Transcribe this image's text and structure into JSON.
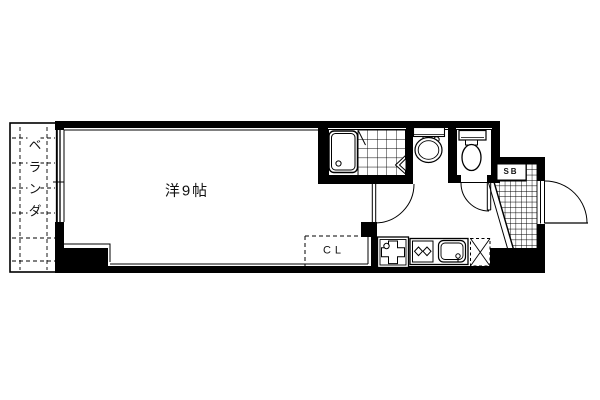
{
  "labels": {
    "room": "洋9帖",
    "balcony": "ベランダ",
    "closet": "CL",
    "shoe_box": "SB"
  },
  "colors": {
    "line": "#000000",
    "background": "#ffffff"
  },
  "fixtures": [
    "balcony-rail",
    "window",
    "bathtub",
    "bathroom-tile-floor",
    "bathroom-folding-door",
    "washbasin",
    "toilet",
    "interior-door",
    "toilet-door",
    "entrance-tile-floor",
    "entrance-step",
    "entry-door",
    "shoe-box",
    "closet",
    "washing-machine",
    "gas-stove",
    "kitchen-sink",
    "refrigerator-space"
  ]
}
